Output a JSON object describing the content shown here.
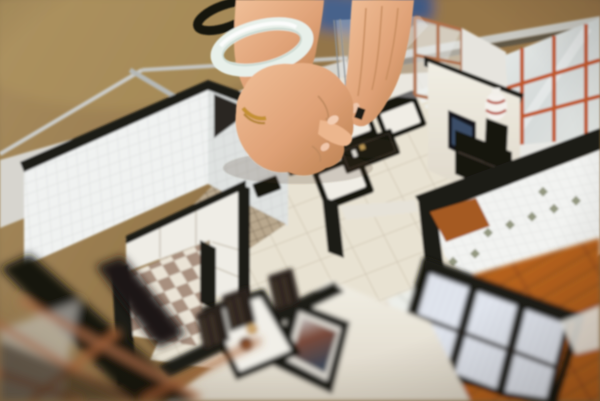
{
  "meta": {
    "media_type": "photograph",
    "subject": "A person's hand with a white jade bangle bracelet and gold ring reaches into a miniature architectural scale model of an apartment to adjust tiny black-and-white furniture",
    "visible_text": []
  },
  "palette": {
    "bg-floor-brown": "#937549",
    "bg-floor-light": "#a98e60",
    "denim-blue": "#46628b",
    "wall-cream": "#e9e5da",
    "wall-black": "#1d1a17",
    "panel-white": "#f0eee8",
    "metal-frame": "#c9c9c3",
    "floor-tile": "#e8e2d2",
    "floor-grout": "#d3cab8",
    "tile-white": "#f0f2f1",
    "checker-dark": "#a8907f",
    "checker-light": "#eae3d5",
    "sofa-black": "#17130f",
    "cushion-white": "#f0ede5",
    "wood-floor": "#b4611f",
    "wood-dark": "#7c3d12",
    "shoji-panel": "#e2e6ee",
    "lattice-orange": "#c0592b",
    "lattice-copper": "#b0714a",
    "skin-mid": "#dfa176",
    "skin-light": "#f0bf98",
    "skin-shadow": "#b97f4f",
    "jade-white": "#e8f0ea",
    "hairtie-black": "#141210",
    "ring-gold": "#c59135",
    "tv-screen": "#3b4d68",
    "vase-red": "#b4452e"
  },
  "scene": {
    "background": [
      "blurred showroom marble floor",
      "blue denim clothing of person"
    ],
    "model_rooms": [
      "left bathroom with white wall tiles",
      "kitchen with checkerboard floor and white cabinets",
      "living room with black-and-white sofa set and coffee table",
      "dining corner with table, slatted chairs and food miniatures",
      "right bathroom with diamond-motif tile floor and orange lattice window",
      "bedroom with shoji wardrobe and wood plank floor"
    ],
    "objects": [
      "glass cover edges",
      "TV console with vase",
      "framed picture on wall",
      "white chaise on balcony"
    ],
    "hands": [
      "left arm with black hair tie, jade bangle, closed hand with gold ring",
      "right-hand fingers pinching a white sofa cushion"
    ]
  }
}
